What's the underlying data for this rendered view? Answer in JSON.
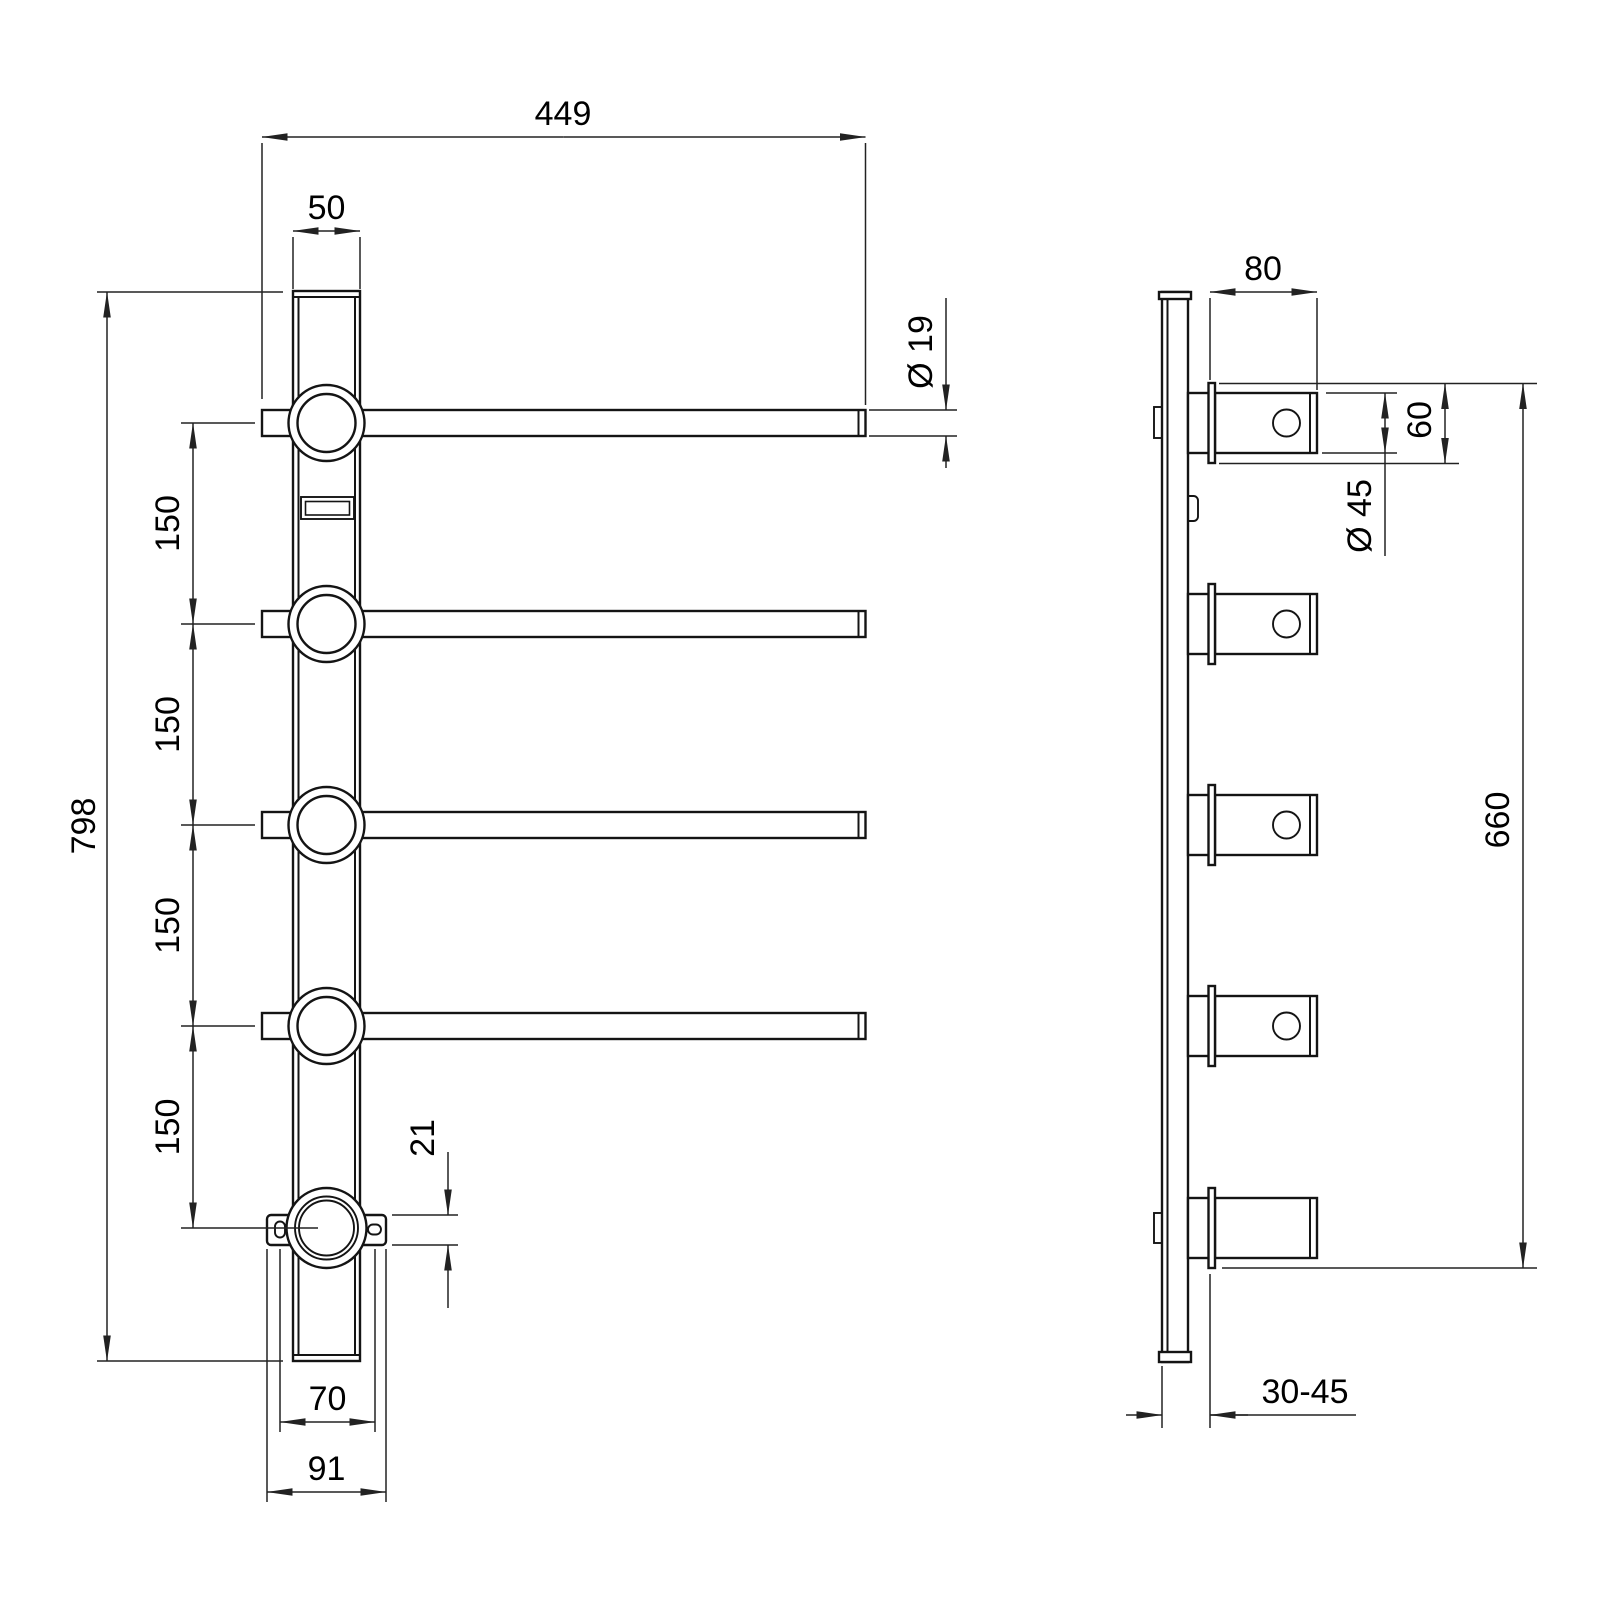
{
  "drawing": {
    "kind": "technical-drawing",
    "units": "mm",
    "colors": {
      "background": "#ffffff",
      "line": "#141414",
      "dimension_line": "#222222",
      "text": "#000000"
    },
    "front_view": {
      "dimensions": {
        "overall_width": "449",
        "rail_width": "50",
        "arm_diameter": "Ø 19",
        "overall_height": "798",
        "arm_spacing": [
          "150",
          "150",
          "150",
          "150"
        ],
        "bracket_thickness": "21",
        "slot_spacing": "70",
        "bracket_width": "91"
      }
    },
    "side_view": {
      "dimensions": {
        "arm_projection": "80",
        "flange_size": "60",
        "housing_diameter": "Ø 45",
        "fixing_centres": "660",
        "wall_clearance": "30-45"
      }
    }
  }
}
